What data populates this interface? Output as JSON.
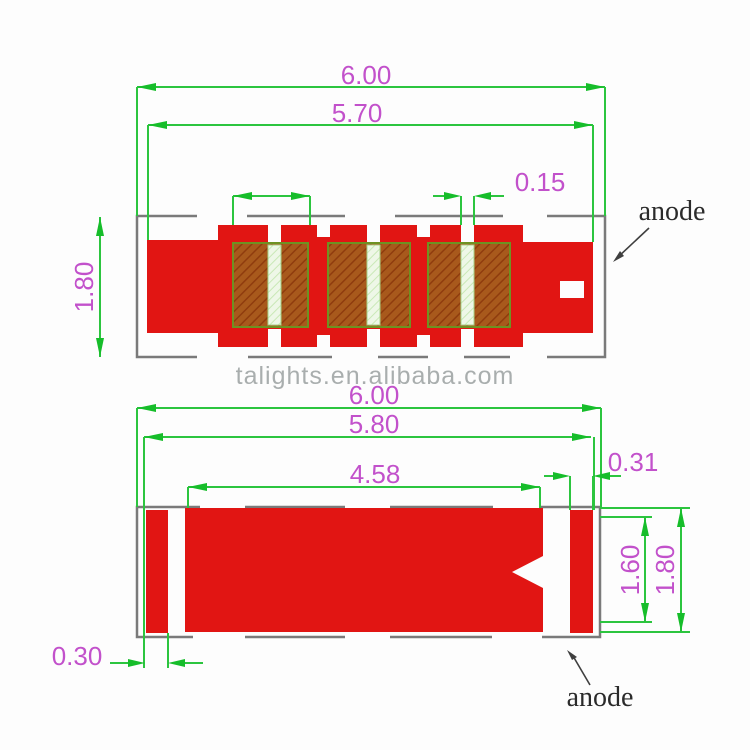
{
  "watermark": "talights.en.alibaba.com",
  "colors": {
    "body_red": "#e11513",
    "dim_line_green": "#2cc53f",
    "dim_text_magenta": "#c251cb",
    "outline_gray": "#7a7a7a",
    "hatch_pad_base": "#a8591c",
    "hatch_pad_line": "#8f3c0e",
    "pale_gap_base": "#eef7e7",
    "pale_gap_line": "#c9e8b6",
    "watermark_gray": "#a9aeae"
  },
  "top_view": {
    "dim_overall_length": "6.00",
    "dim_body_length": "5.70",
    "dim_gap_width": "0.15",
    "dim_height": "1.80",
    "anode_label": "anode"
  },
  "bottom_view": {
    "dim_overall_length": "6.00",
    "dim_body_length": "5.80",
    "dim_pad_length": "4.58",
    "dim_right_gap": "0.31",
    "dim_left_pad_width": "0.30",
    "dim_inner_height": "1.60",
    "dim_height": "1.80",
    "anode_label": "anode"
  }
}
